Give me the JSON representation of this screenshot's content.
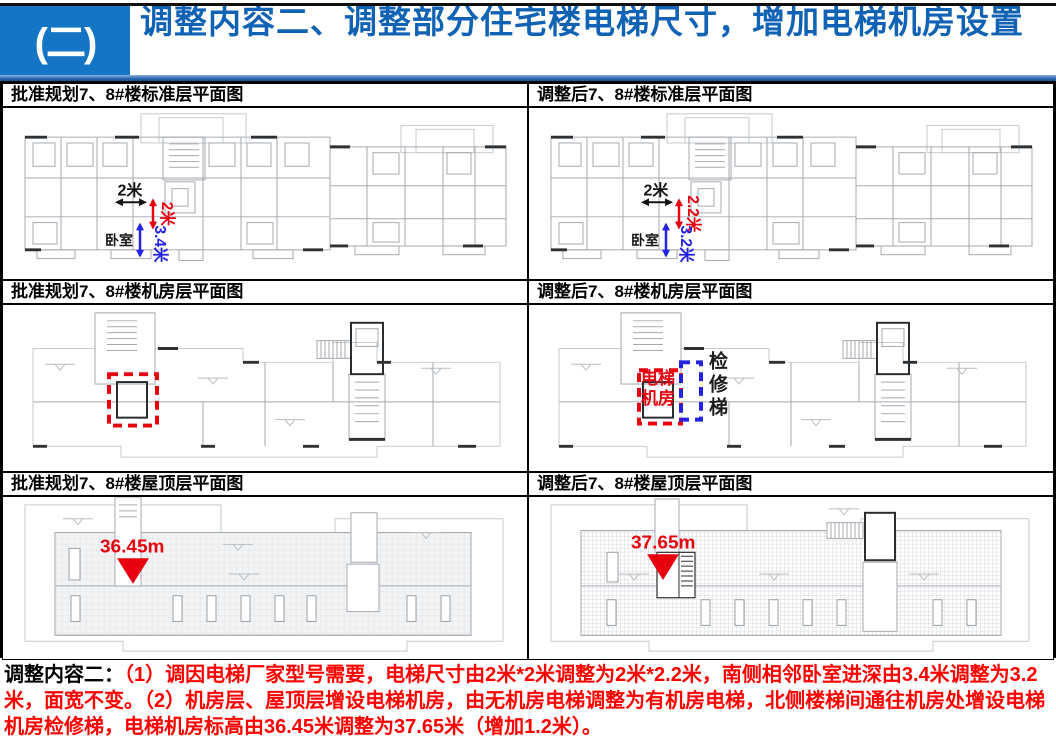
{
  "header": {
    "badge": "(二)",
    "title": "调整内容二、调整部分住宅楼电梯尺寸，增加电梯机房设置"
  },
  "panels": {
    "std_approved": {
      "title": "批准规划7、8#楼标准层平面图",
      "elevator_width": "2米",
      "elevator_depth": "2米",
      "bedroom_depth": "3.4米",
      "bedroom_label": "卧室"
    },
    "std_adjusted": {
      "title": "调整后7、8#楼标准层平面图",
      "elevator_width": "2米",
      "elevator_depth": "2.2米",
      "bedroom_depth": "3.2米",
      "bedroom_label": "卧室"
    },
    "machine_approved": {
      "title": "批准规划7、8#楼机房层平面图"
    },
    "machine_adjusted": {
      "title": "调整后7、8#楼机房层平面图",
      "machine_room_label": "电梯机房",
      "ladder_label": "检修梯"
    },
    "roof_approved": {
      "title": "批准规划7、8#楼屋顶层平面图",
      "elevation": "36.45m"
    },
    "roof_adjusted": {
      "title": "调整后7、8#楼屋顶层平面图",
      "elevation": "37.65m"
    }
  },
  "footer": {
    "label": "调整内容二：",
    "text": "（1）调因电梯厂家型号需要，电梯尺寸由2米*2米调整为2米*2.2米，南侧相邻卧室进深由3.4米调整为3.2米，面宽不变。（2）机房层、屋顶层增设电梯机房，由无机房电梯调整为有机房电梯，北侧楼梯间通往机房处增设电梯机房检修梯，电梯机房标高由36.45米调整为37.65米（增加1.2米）。"
  },
  "colors": {
    "header_blue": "#1474C5",
    "title_blue": "#1062B4",
    "rule_blue": "#2E6DB4",
    "annotation_red": "#E8000E",
    "annotation_blue": "#2222E0",
    "footer_red": "#FF0000"
  }
}
